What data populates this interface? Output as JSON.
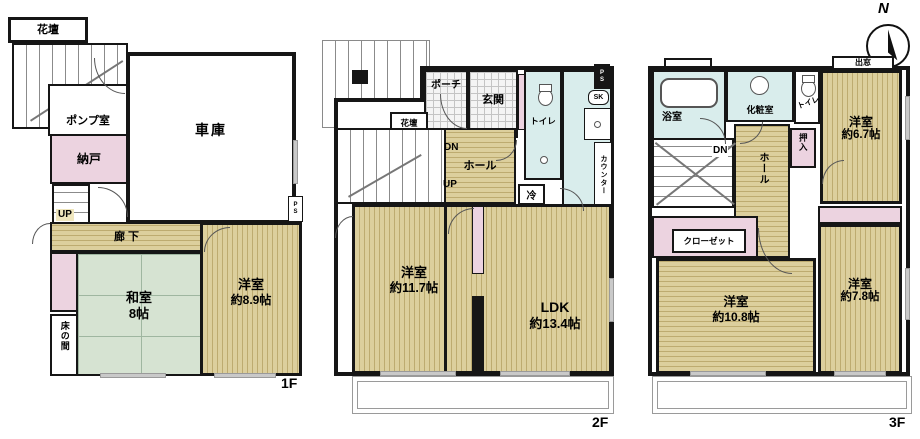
{
  "meta": {
    "type": "madori-floor-plan",
    "compass_north": "N"
  },
  "colors": {
    "wood": "#dccf9d",
    "wood_stripe": "#bdab70",
    "tatami": "#d6e3d2",
    "wet_area": "#d9edec",
    "storage_pink": "#ecd3e0",
    "wall": "#161616"
  },
  "f1": {
    "floor_label": "1F",
    "kadan": "花壇",
    "pump_room": "ポンプ室",
    "nando": "納戸",
    "up": "UP",
    "garage": "車庫",
    "rouka": "廊下",
    "washitsu": "和室",
    "washitsu_size": "8帖",
    "youshitsu": "洋室",
    "youshitsu_size": "約8.9帖",
    "tokonoma": "床の間",
    "ps": "PS"
  },
  "f2": {
    "floor_label": "2F",
    "porch": "ポーチ",
    "genkan": "玄関",
    "kadan": "花壇",
    "dn": "DN",
    "up": "UP",
    "hall": "ホール",
    "toilet": "トイレ",
    "fridge": "冷",
    "sk": "SK",
    "ps": "PS",
    "counter": "カウンター",
    "youshitsu": "洋室",
    "youshitsu_size": "約11.7帖",
    "ldk": "LDK",
    "ldk_size": "約13.4帖"
  },
  "f3": {
    "floor_label": "3F",
    "bath": "浴室",
    "powder_room": "化粧室",
    "toilet": "トイレ",
    "bay_window": "出窓",
    "youshitsu_a": "洋室",
    "youshitsu_a_size": "約6.7帖",
    "oshiire": "押入",
    "dn": "DN",
    "hall": "ホール",
    "closet": "クローゼット",
    "youshitsu_b": "洋室",
    "youshitsu_b_size": "約10.8帖",
    "youshitsu_c": "洋室",
    "youshitsu_c_size": "約7.8帖"
  }
}
